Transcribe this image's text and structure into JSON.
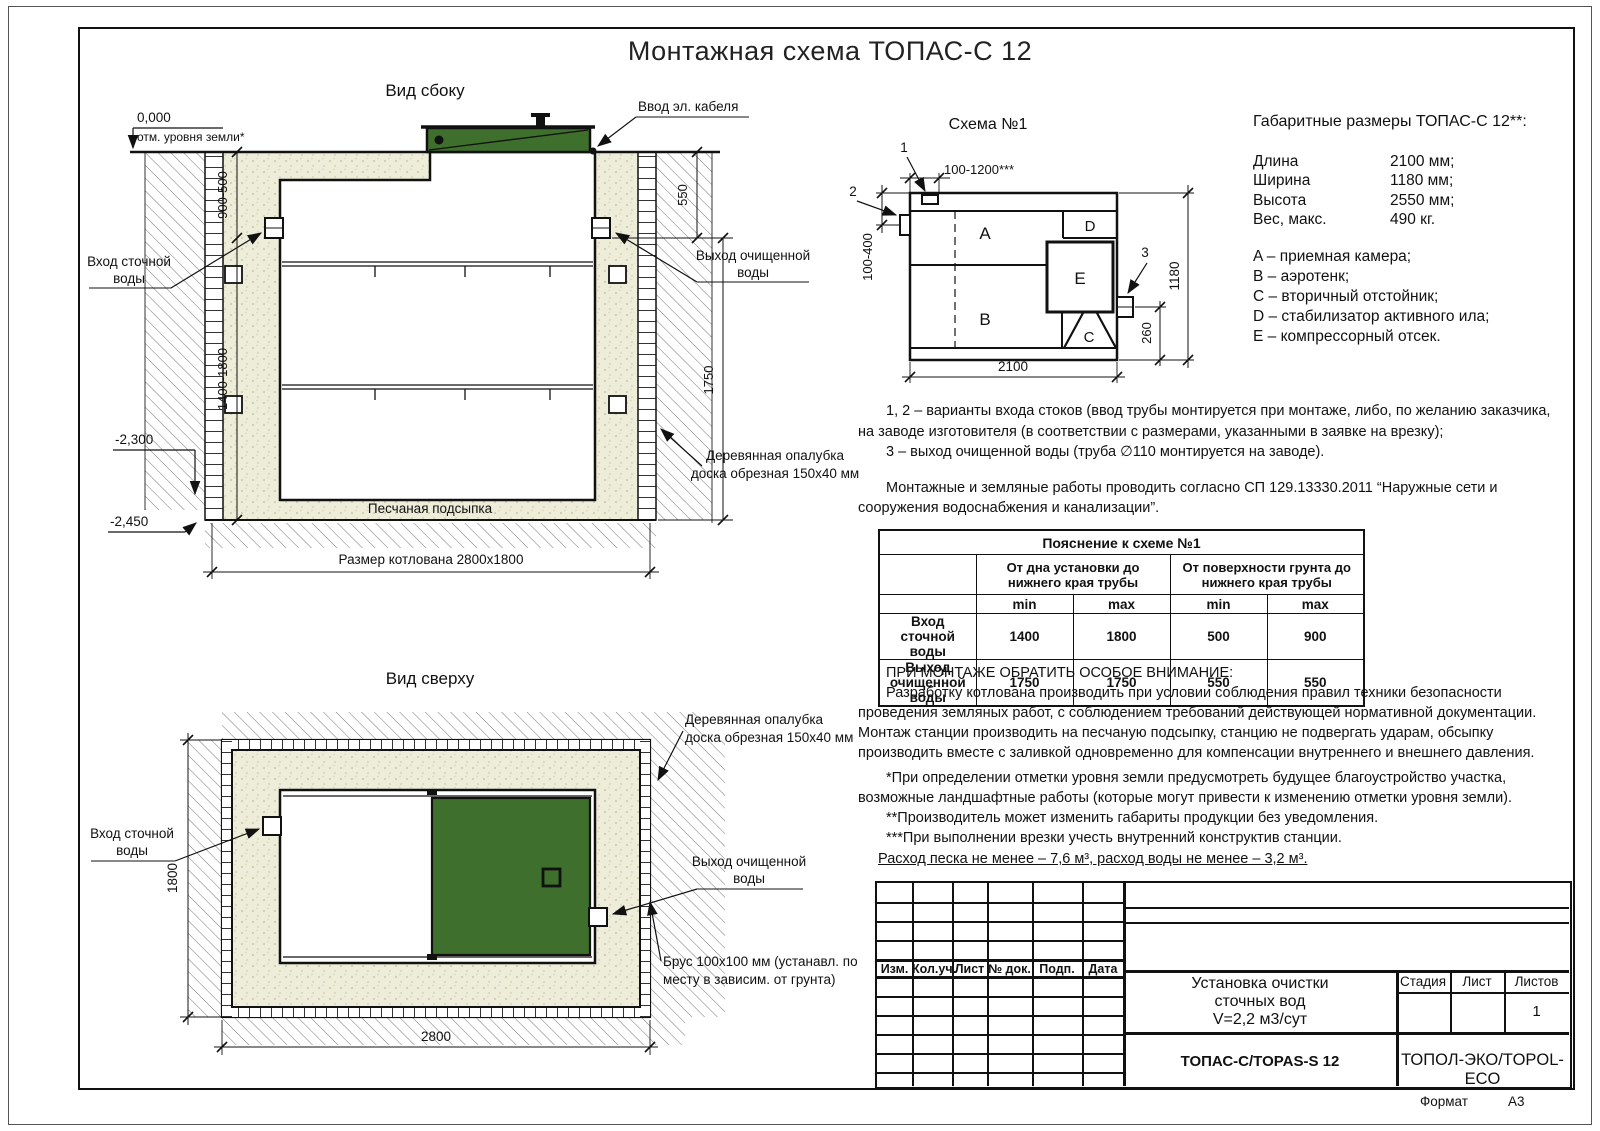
{
  "title": "Монтажная схема ТОПАС-С 12",
  "colors": {
    "lid_green": "#3f6f2c",
    "sand": "#ededda"
  },
  "side_view": {
    "label": "Вид сбоку",
    "zero_mark": "0,000",
    "zero_note": "отм. уровня земли*",
    "dim_depth_top": "900-500",
    "dim_depth_main": "1400-1800",
    "elev_bottom_tank": "-2,300",
    "elev_pit": "-2,450",
    "dim_550": "550",
    "dim_1750": "1750",
    "cable_label": "Ввод эл. кабеля",
    "inlet_line1": "Вход сточной",
    "inlet_line2": "воды",
    "outlet_line1": "Выход очищенной",
    "outlet_line2": "воды",
    "formwork_line1": "Деревянная опалубка",
    "formwork_line2": "доска обрезная 150x40 мм",
    "sand_label": "Песчаная подсыпка",
    "pit_dim": "Размер котлована 2800x1800"
  },
  "schema": {
    "label": "Схема №1",
    "dim_top": "100-1200***",
    "dim_left": "100-400",
    "dim_width": "1180",
    "dim_260": "260",
    "dim_length": "2100",
    "marker1": "1",
    "marker2": "2",
    "marker3": "3",
    "comp_a": "A",
    "comp_b": "B",
    "comp_c": "C",
    "comp_d": "D",
    "comp_e": "E"
  },
  "overall": {
    "title": "Габаритные размеры ТОПАС-С 12**:",
    "rows": [
      {
        "label": "Длина",
        "value": "2100 мм;"
      },
      {
        "label": "Ширина",
        "value": "1180 мм;"
      },
      {
        "label": "Высота",
        "value": "2550 мм;"
      },
      {
        "label": "Вес, макс.",
        "value": "490 кг."
      }
    ],
    "legend": [
      "A – приемная камера;",
      "B – аэротенк;",
      "C – вторичный отстойник;",
      "D – стабилизатор активного ила;",
      "E – компрессорный отсек."
    ]
  },
  "notes": {
    "variants": "1, 2 – варианты входа  стоков (ввод трубы монтируется при монтаже, либо, по желанию заказчика, на заводе изготовителя (в соответствии с размерами, указанными в заявке на врезку);",
    "outlet": "3 – выход очищенной воды (труба ∅110 монтируется на заводе).",
    "sp": "Монтажные и земляные работы проводить согласно СП 129.13330.2011 “Наружные сети и сооружения водоснабжения и канализации”."
  },
  "pipe_table": {
    "title": "Пояснение к схеме №1",
    "group1": "От дна установки до нижнего края трубы",
    "group2": "От поверхности грунта до нижнего края трубы",
    "min1": "min",
    "max1": "max",
    "min2": "min",
    "max2": "max",
    "rows": [
      {
        "label": "Вход сточной воды",
        "v1": "1400",
        "v2": "1800",
        "v3": "500",
        "v4": "900"
      },
      {
        "label": "Выход очищенной воды",
        "v1": "1750",
        "v2": "1750",
        "v3": "550",
        "v4": "550"
      }
    ]
  },
  "attention": {
    "title": "ПРИ МОНТАЖЕ ОБРАТИТЬ ОСОБОЕ ВНИМАНИЕ:",
    "body": "Разработку котлована производить при условии соблюдения правил техники безопасности проведения земляных работ, с соблюдением требований действующей нормативной документации. Монтаж станции производить на песчаную подсыпку, станцию не подвергать ударам, обсыпку производить вместе с заливкой одновременно для компенсации внутреннего и внешнего давления.",
    "fn1": "*При определении отметки уровня земли предусмотреть будущее благоустройство участка, возможные ландшафтные работы (которые могут привести к изменению отметки уровня земли).",
    "fn2": "**Производитель может изменить габариты продукции без уведомления.",
    "fn3": "***При выполнении врезки учесть внутренний конструктив станции.",
    "consumption": "Расход песка не менее – 7,6 м³, расход воды не менее – 3,2 м³."
  },
  "top_view": {
    "label": "Вид сверху",
    "dim_1800": "1800",
    "dim_2800": "2800",
    "inlet_line1": "Вход сточной",
    "inlet_line2": "воды",
    "outlet_line1": "Выход очищенной",
    "outlet_line2": "воды",
    "formwork_line1": "Деревянная опалубка",
    "formwork_line2": "доска обрезная 150x40 мм",
    "beam_line1": "Брус 100x100 мм (устанавл. по",
    "beam_line2": "месту в зависим. от грунта)"
  },
  "title_block": {
    "rev_cols": [
      "Изм.",
      "Кол.уч.",
      "Лист",
      "№ док.",
      "Подп.",
      "Дата"
    ],
    "doc_line1": "Установка очистки",
    "doc_line2": "сточных вод",
    "doc_line3": "V=2,2 м3/сут",
    "stage": "Стадия",
    "sheet": "Лист",
    "sheets": "Листов",
    "sheets_value": "1",
    "model": "ТОПАС-С/TOPAS-S 12",
    "company": "ТОПОЛ-ЭКО/TOPOL-ECO",
    "format_label": "Формат",
    "format_value": "A3"
  }
}
